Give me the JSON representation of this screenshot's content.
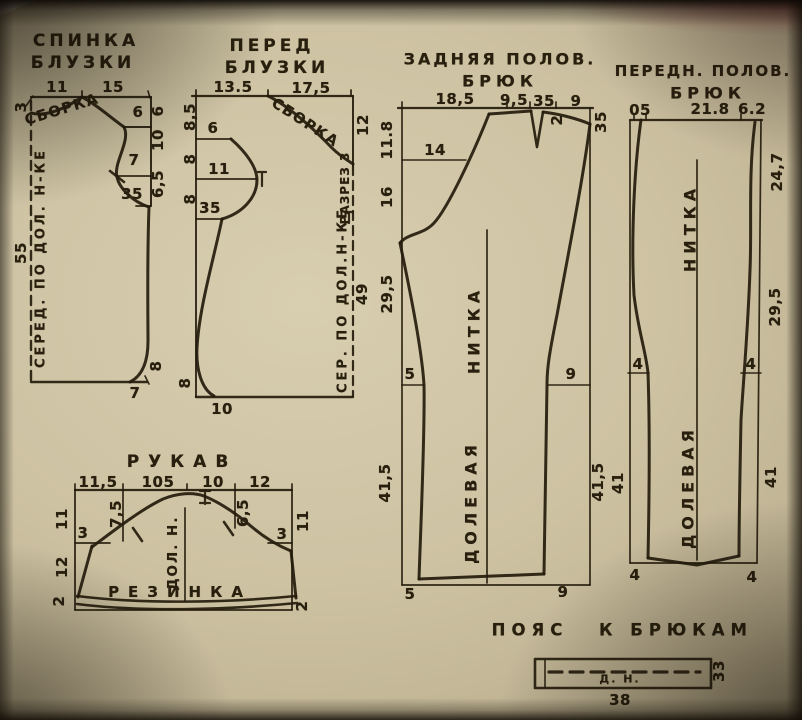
{
  "photo": {
    "paper_color": "#cdc2a2",
    "ink_color": "#241b0c"
  },
  "back_blouse": {
    "t1": "СПИНКА",
    "t2": "БЛУЗКИ",
    "w1": "11",
    "w2": "15",
    "neck_drop": "3",
    "gather": "СБОРКА",
    "d6": "6",
    "d7": "7",
    "d35": "35",
    "r1": "6",
    "r2": "10",
    "r3": "6,5",
    "r4": "8",
    "len": "55",
    "fold": "СЕРЕД. ПО ДОЛ. Н-КЕ",
    "bottom": "7"
  },
  "front_blouse": {
    "t1": "ПЕРЕД",
    "t2": "БЛУЗКИ",
    "w1": "13.5",
    "w2": "17,5",
    "gather": "СБОРКА",
    "l1": "8,5",
    "l2": "8",
    "l3": "8",
    "l4": "8",
    "d6": "6",
    "d11": "11",
    "d35": "35",
    "neck_depth": "12",
    "slit": "РАЗРЕЗ 3",
    "len": "49",
    "fold": "СЕР. ПО ДОЛ.Н-КЕ",
    "bottom": "10"
  },
  "back_trousers": {
    "t1": "ЗАДНЯЯ ПОЛОВ.",
    "t2": "БРЮК",
    "w1": "18,5",
    "w2": "9,5",
    "w3": "35",
    "w4": "9",
    "dart": "2",
    "side": "35",
    "l1": "11.8",
    "l2": "16",
    "l3": "29,5",
    "l4": "41,5",
    "d14": "14",
    "hip_l": "5",
    "hip_r": "9",
    "r1": "41,5",
    "grain1": "ДОЛЕВАЯ",
    "grain2": "НИТКА",
    "b1": "5",
    "b2": "9"
  },
  "front_trousers": {
    "t1": "ПЕРЕДН. ПОЛОВ.",
    "t2": "БРЮК",
    "w1": "05",
    "w2": "21.8",
    "w3": "6.2",
    "r1": "24,7",
    "r2": "29,5",
    "r3": "41",
    "l1": "41",
    "hip_l": "4",
    "hip_r": "4",
    "grain1": "ДОЛЕВАЯ",
    "grain2": "НИТКА",
    "b1": "4",
    "b2": "4"
  },
  "sleeve": {
    "t": "РУКАВ",
    "w1": "11,5",
    "w2": "105",
    "w3": "10",
    "w4": "12",
    "l1": "11",
    "l2": "12",
    "l3": "2",
    "r1": "11",
    "r2": "2",
    "cap_l": "3",
    "cap_r": "3",
    "in_l": "7,5",
    "in_r": "6,5",
    "grain": "ДОЛ. Н.",
    "elastic": "РЕЗИНКА"
  },
  "belt": {
    "t1": "ПОЯС",
    "t2": "К БРЮКАМ",
    "grain": "Д. Н.",
    "len": "38",
    "wid": "33"
  }
}
